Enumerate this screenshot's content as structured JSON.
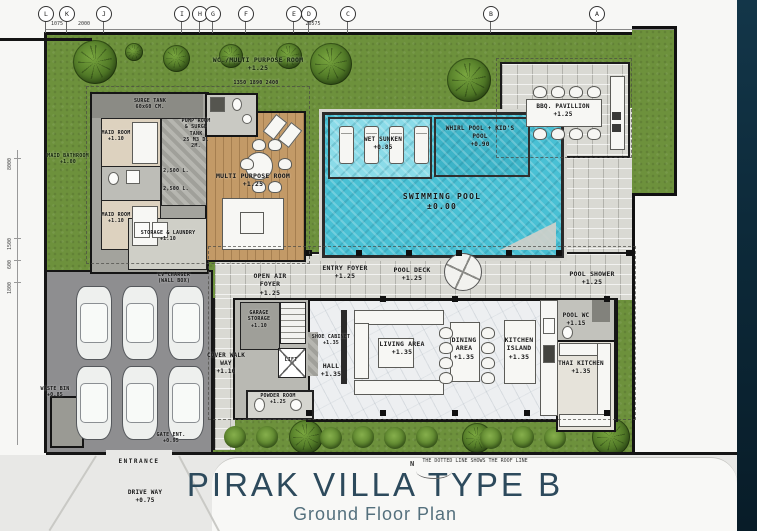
{
  "title": {
    "main": "PIRAK VILLA TYPE B",
    "subtitle": "Ground Floor Plan"
  },
  "site_note": {
    "line1": "THE DOTTED LINE SHOWS",
    "line2": "THE ROOF LINE"
  },
  "north": "N",
  "grid_markers": [
    {
      "label": "L",
      "x": 45
    },
    {
      "label": "K",
      "x": 66
    },
    {
      "label": "J",
      "x": 103
    },
    {
      "label": "I",
      "x": 181
    },
    {
      "label": "H",
      "x": 199
    },
    {
      "label": "G",
      "x": 212
    },
    {
      "label": "F",
      "x": 245
    },
    {
      "label": "E",
      "x": 293
    },
    {
      "label": "D",
      "x": 308
    },
    {
      "label": "C",
      "x": 347
    },
    {
      "label": "B",
      "x": 490
    },
    {
      "label": "A",
      "x": 596
    }
  ],
  "top_dims": [
    {
      "t": "1075",
      "x": 57
    },
    {
      "t": "2000",
      "x": 84
    },
    {
      "t": "20575",
      "x": 313
    }
  ],
  "left_dims": [
    {
      "t": "8000",
      "y": 158
    },
    {
      "t": "1500",
      "y": 238
    },
    {
      "t": "600",
      "y": 260
    },
    {
      "t": "1800",
      "y": 282
    }
  ],
  "dims": {
    "wc_top": "1350   1890   2400"
  },
  "rooms": {
    "wc_multi": {
      "name": "WC./MULTI PURPOSE ROOM",
      "level": "+1.25"
    },
    "surge_tank": {
      "name": "SURGE TANK",
      "size": "60x60 CM."
    },
    "maid_room_1": {
      "name": "MAID ROOM",
      "level": "+1.10"
    },
    "maid_room_2": {
      "name": "MAID ROOM",
      "level": "+1.10"
    },
    "maid_bathroom": {
      "name": "MAID BATHROOM",
      "level": "+1.00"
    },
    "pump_room": {
      "name": "PUMP ROOM & SURGE TANK",
      "size": "25 M3 D. 2M."
    },
    "tank_capacity": "2,500 L.",
    "storage_laundry": {
      "name": "STORAGE & LAUNDRY",
      "level": "+1.10"
    },
    "multi_purpose": {
      "name": "MULTI PURPOSE ROOM",
      "level": "+1.25"
    },
    "wet_sunken": {
      "name": "WET SUNKEN",
      "level": "+0.85"
    },
    "whirl_pool": {
      "name": "WHIRL POOL + KID'S POOL",
      "level": "+0.90"
    },
    "swimming_pool": {
      "name": "SWIMMING POOL",
      "level": "±0.00"
    },
    "bbq_pavillion": {
      "name": "BBQ. PAVILLION",
      "level": "+1.25"
    },
    "entry_foyer": {
      "name": "ENTRY FOYER",
      "level": "+1.25"
    },
    "pool_deck": {
      "name": "POOL DECK",
      "level": "+1.25"
    },
    "pool_shower": {
      "name": "POOL SHOWER",
      "level": "+1.25"
    },
    "pool_wc": {
      "name": "POOL WC",
      "level": "+1.15"
    },
    "thai_kitchen": {
      "name": "THAI KITCHEN",
      "level": "+1.35"
    },
    "living_area": {
      "name": "LIVING AREA",
      "level": "+1.35"
    },
    "dining_area": {
      "name": "DINING AREA",
      "level": "+1.35"
    },
    "kitchen_island": {
      "name": "KITCHEN ISLAND",
      "level": "+1.35"
    },
    "open_air_foyer": {
      "name": "OPEN AIR FOYER",
      "level": "+1.25"
    },
    "garage_storage": {
      "name": "GARAGE STORAGE",
      "level": "+1.10"
    },
    "shoe_cabinet": {
      "name": "SHOE CABINET",
      "level": "+1.35"
    },
    "hall": {
      "name": "HALL",
      "level": "+1.35"
    },
    "lift": {
      "name": "LIFT"
    },
    "powder_room": {
      "name": "POWDER ROOM",
      "level": "+1.25"
    },
    "cover_walkway": {
      "name": "COVER WALK WAY",
      "level": "+1.10"
    },
    "ev_charger": {
      "line1": "EV CHARGER",
      "line2": "(WALL BOX)"
    },
    "waste": {
      "name": "WASTE BIN",
      "level": "+0.85"
    },
    "gate_ent": {
      "name": "GATE ENT.",
      "level": "+0.95"
    },
    "entrance": {
      "name": "ENTRANCE"
    },
    "drive_way": {
      "name": "DRIVE WAY",
      "level": "+0.75"
    }
  },
  "colors": {
    "grass": "#6d913c",
    "water": "#49c0d4",
    "stone": "#d9d9d3",
    "side_band": "#0d2a3a",
    "title": "#2d4a5c"
  }
}
